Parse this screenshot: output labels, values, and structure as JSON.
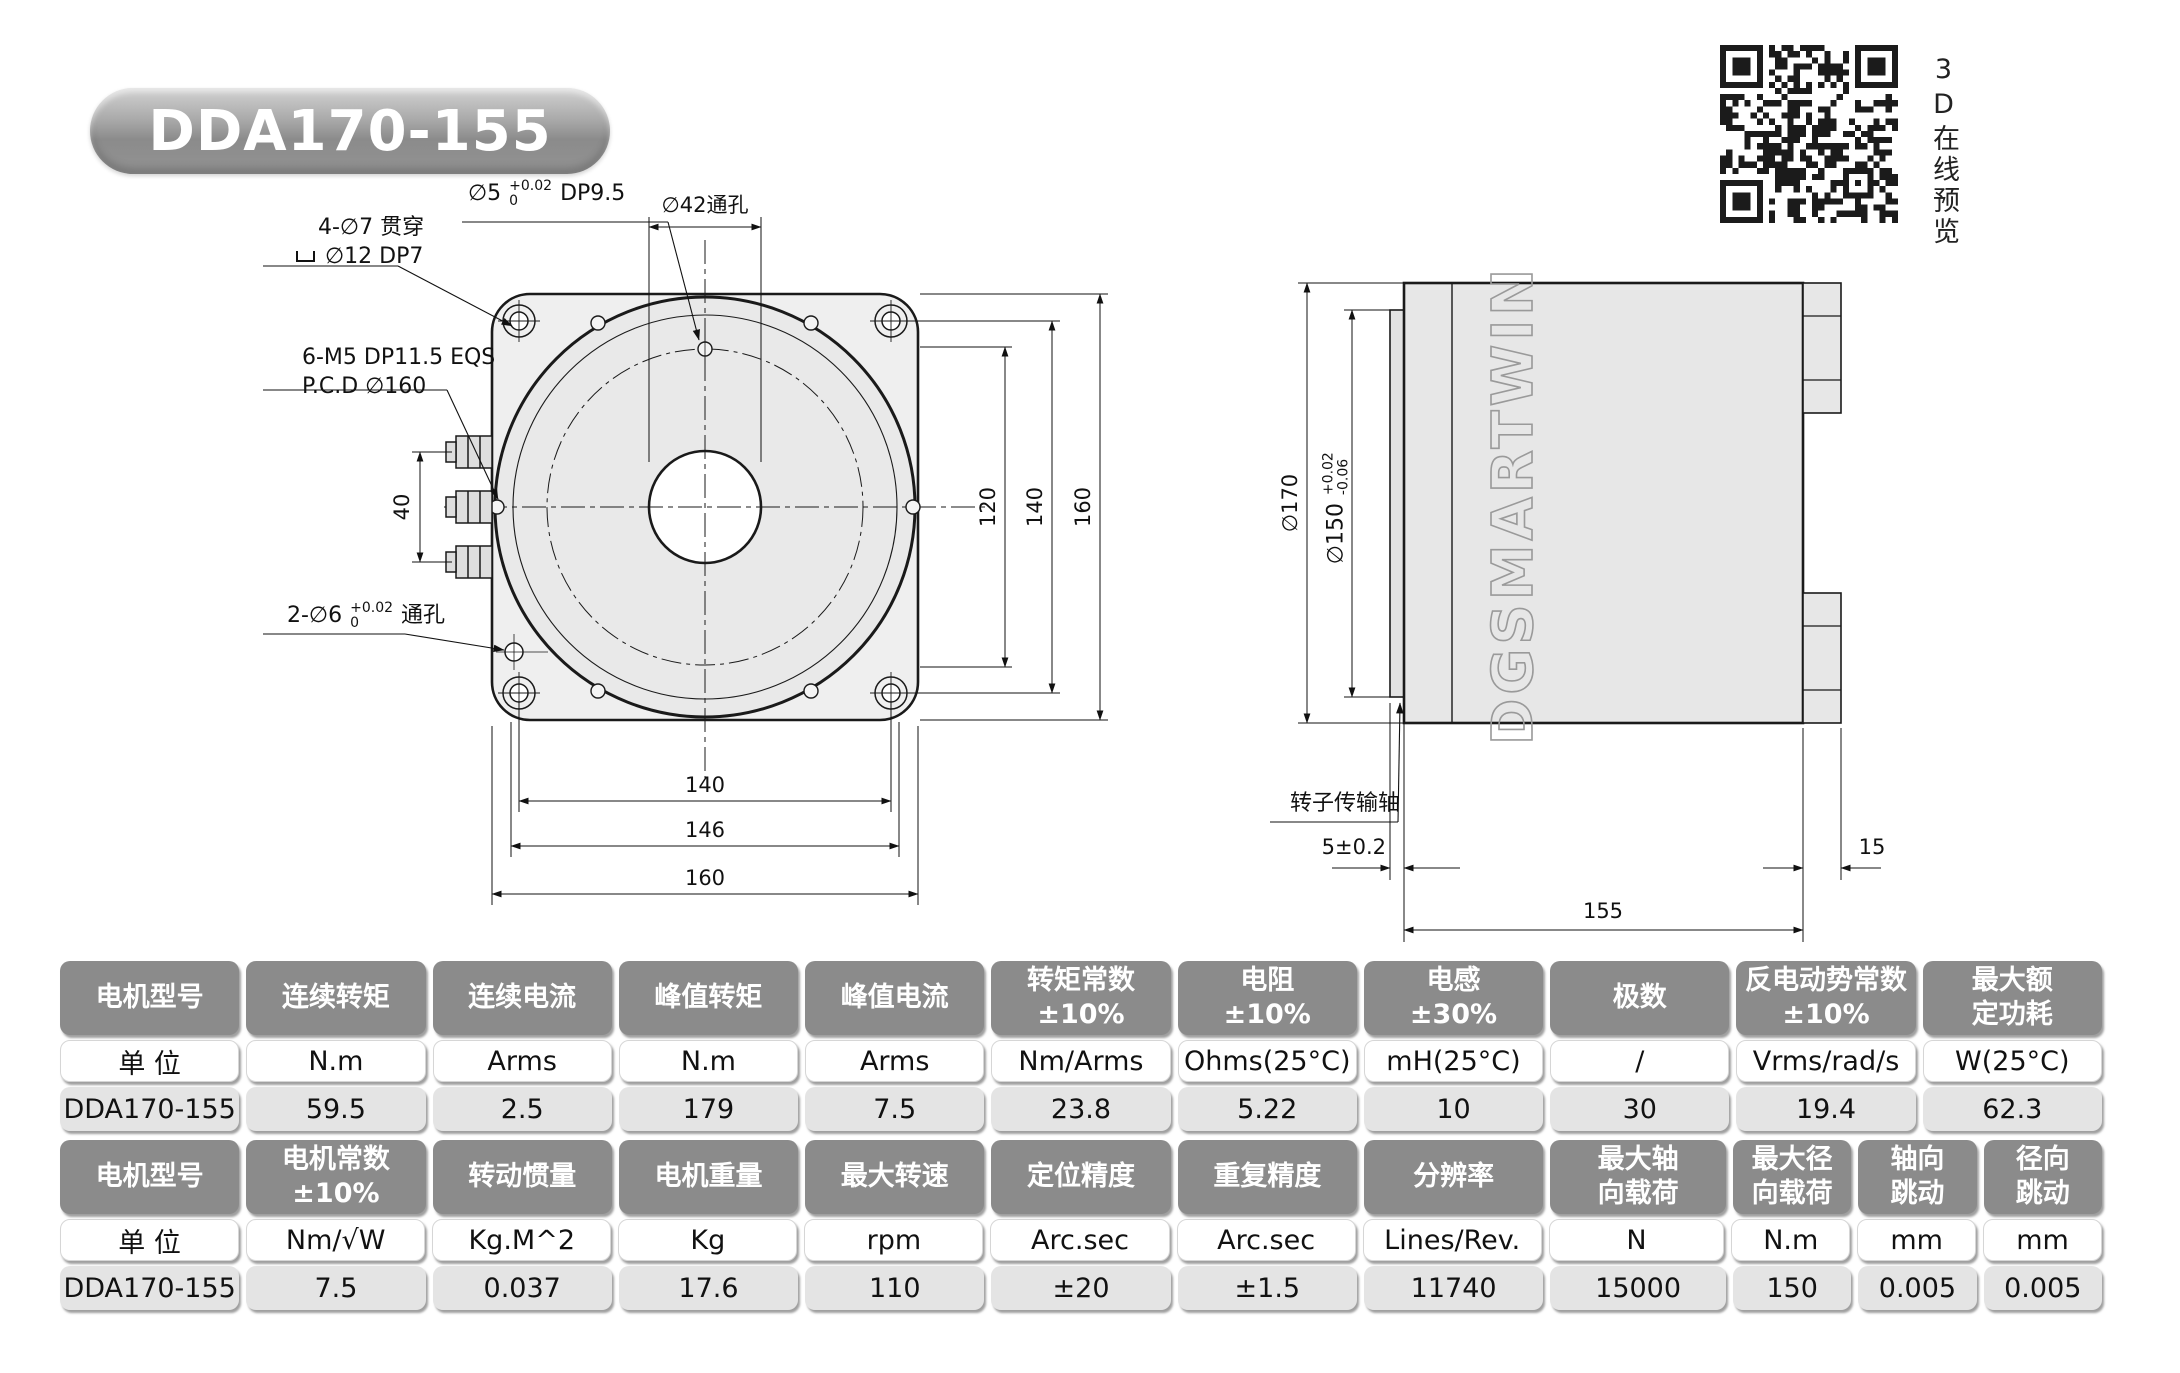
{
  "page": {
    "title_badge": "DDA170-155"
  },
  "qr": {
    "caption": "3D在线预览"
  },
  "front": {
    "pin_hole": {
      "d": "∅5",
      "tol_plus": "+0.02",
      "tol_zero": "0",
      "depth": "DP9.5"
    },
    "center_hole": "∅42通孔",
    "corner_hole_line1": "4-∅7 贯穿",
    "corner_hole_line2": "∅12 DP7",
    "tap_line1": "6-M5  DP11.5  EQS",
    "tap_line2": "P.C.D ∅160",
    "through_hole": {
      "d": "2-∅6",
      "tol_plus": "+0.02",
      "tol_zero": "0",
      "suffix": "通孔"
    },
    "dims": {
      "d40": "40",
      "d120": "120",
      "d140": "140",
      "d160": "160",
      "b140": "140",
      "b146": "146",
      "b160": "160"
    }
  },
  "side": {
    "d170": "∅170",
    "d150": "∅150",
    "d150_tol_plus": "+0.02",
    "d150_tol_minus": "-0.06",
    "shaft_label": "转子传输轴",
    "d5": "5±0.2",
    "d155": "155",
    "d15": "15",
    "logo": "DGSMARTWIN"
  },
  "tables": {
    "electrical": {
      "headers": [
        "电机型号",
        "连续转矩",
        "连续电流",
        "峰值转矩",
        "峰值电流",
        "转矩常数\n±10%",
        "电阻\n±10%",
        "电感\n±30%",
        "极数",
        "反电动势常数\n±10%",
        "最大额\n定功耗"
      ],
      "units": [
        "单 位",
        "N.m",
        "Arms",
        "N.m",
        "Arms",
        "Nm/Arms",
        "Ohms(25°C)",
        "mH(25°C)",
        "/",
        "Vrms/rad/s",
        "W(25°C)"
      ],
      "values": [
        "DDA170-155",
        "59.5",
        "2.5",
        "179",
        "7.5",
        "23.8",
        "5.22",
        "10",
        "30",
        "19.4",
        "62.3"
      ]
    },
    "mechanical": {
      "headers": [
        "电机型号",
        "电机常数\n±10%",
        "转动惯量",
        "电机重量",
        "最大转速",
        "定位精度",
        "重复精度",
        "分辨率",
        "最大轴\n向载荷",
        "最大径\n向载荷",
        "轴向\n跳动",
        "径向\n跳动"
      ],
      "units": [
        "单 位",
        "Nm/√W",
        "Kg.M^2",
        "Kg",
        "rpm",
        "Arc.sec",
        "Arc.sec",
        "Lines/Rev.",
        "N",
        "N.m",
        "mm",
        "mm"
      ],
      "values": [
        "DDA170-155",
        "7.5",
        "0.037",
        "17.6",
        "110",
        "±20",
        "±1.5",
        "11740",
        "15000",
        "150",
        "0.005",
        "0.005"
      ]
    }
  },
  "colors": {
    "header_pill": "#8b8b8b",
    "value_pill": "#e4e4e4",
    "drawing_fill": "#ebebeb",
    "line": "#1a1a1a"
  }
}
